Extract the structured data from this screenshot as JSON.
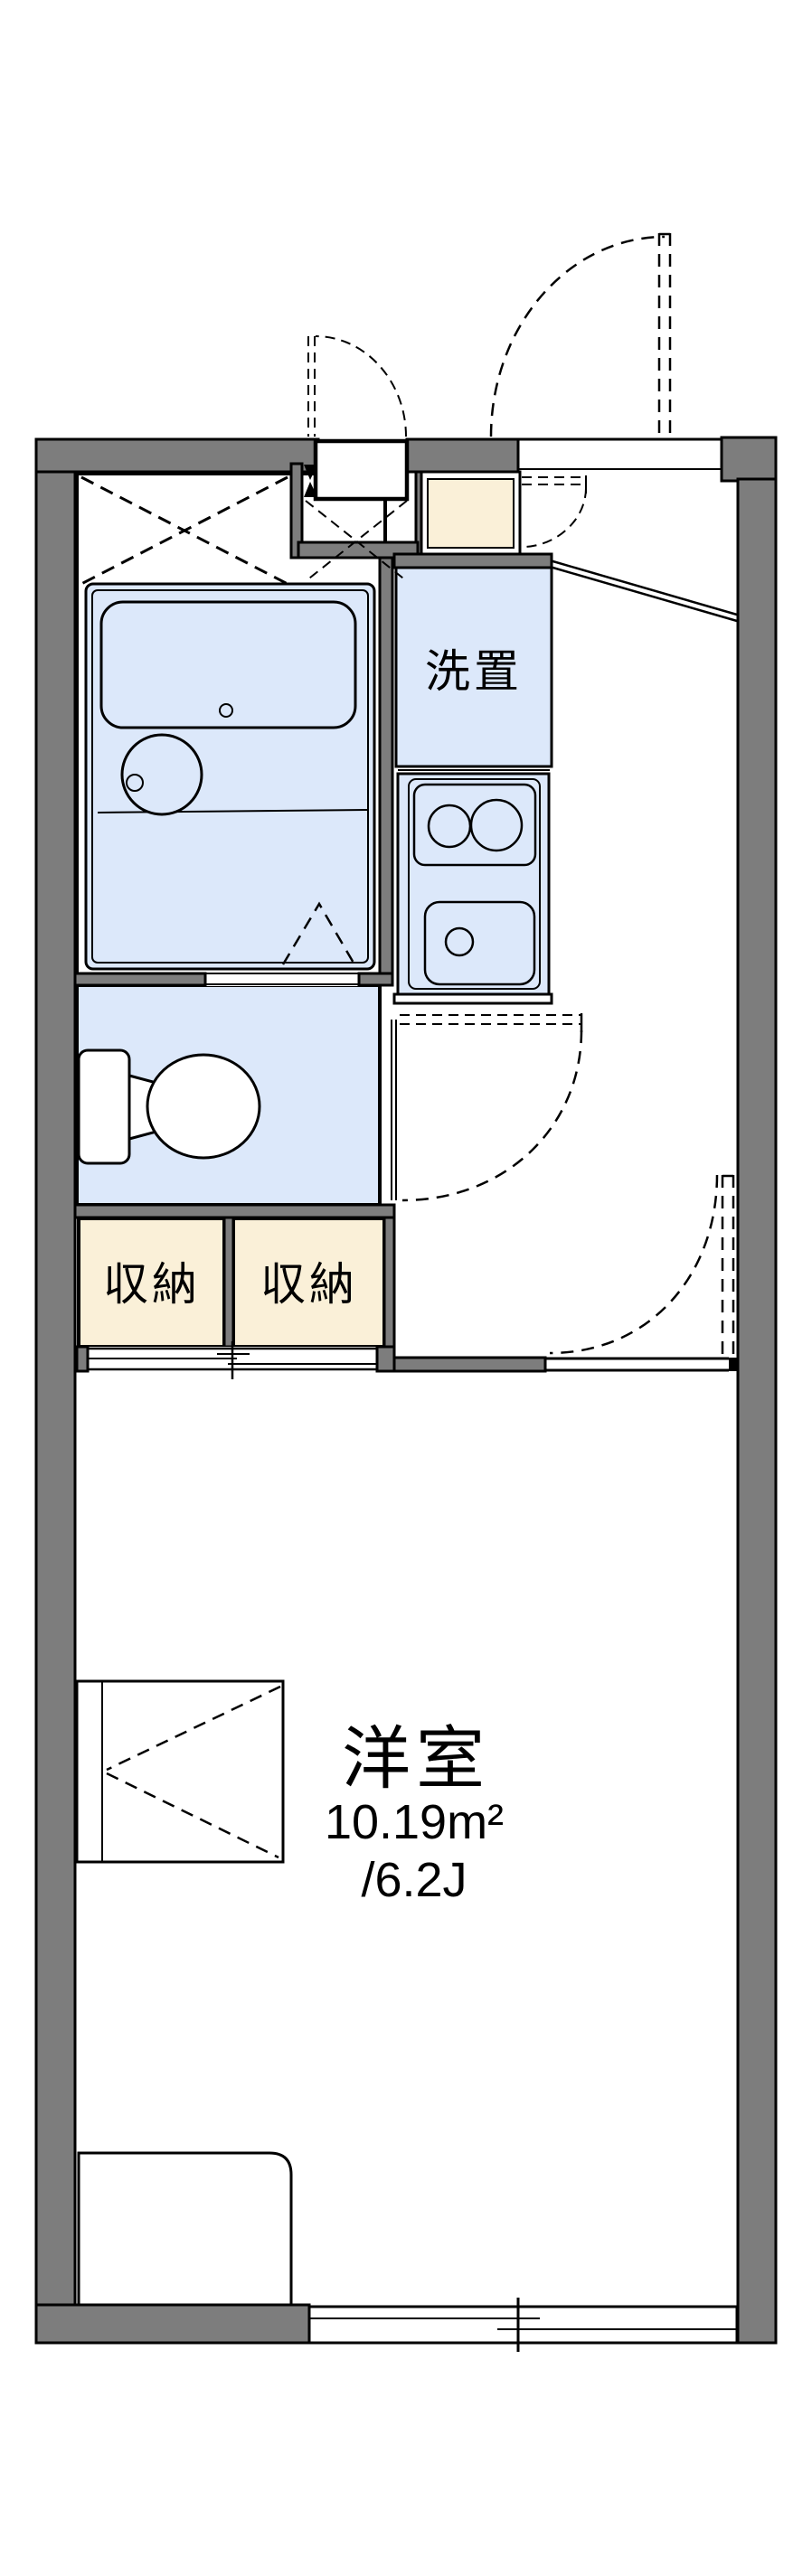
{
  "plan": {
    "type": "apartment-floor-plan",
    "rooms": {
      "western": {
        "name": "洋室",
        "area_sqm": "10.19m²",
        "area_tatami": "/6.2J"
      },
      "laundry": {
        "label": "洗置"
      },
      "storages": [
        {
          "label": "収納"
        },
        {
          "label": "収納"
        }
      ]
    }
  },
  "colors": {
    "wall": "#7d7d7d",
    "line": "#000000",
    "fixture_blue": "#dce8fa",
    "storage_cream": "#faf0d8",
    "background": "#ffffff"
  }
}
